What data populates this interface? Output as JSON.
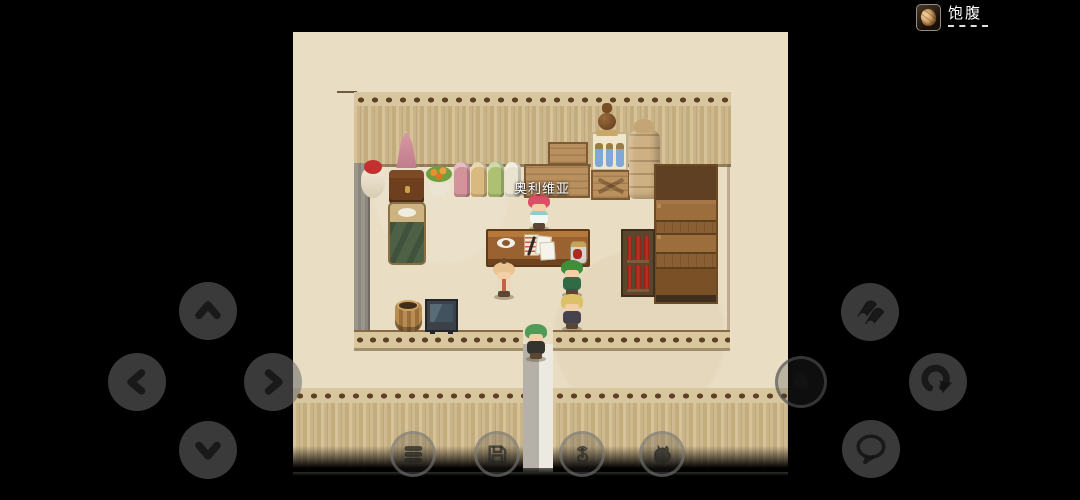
{
  "screen": {
    "width": 1080,
    "height": 500,
    "background": "#000000"
  },
  "hud": {
    "satiety": {
      "label": "饱腹",
      "icon": "bread-icon",
      "underline_style": "dashed"
    }
  },
  "game": {
    "scene": "shop-interior",
    "npc_label": "奥利维亚",
    "characters": [
      "olivia-shopkeeper",
      "child-npc",
      "green-hair-npc",
      "blonde-player",
      "hooded-visitor"
    ],
    "objects": [
      "mannequin",
      "red-doll",
      "wooden-chest",
      "flower-pot",
      "fabric-bolts",
      "crate-stack",
      "jug-on-crate",
      "blue-bottle-crate",
      "brace-crate",
      "sack-pile",
      "goods-shelf",
      "red-bottle-shelf",
      "bread-baskets",
      "counter-desk",
      "coffee-cup",
      "papers-and-quill",
      "preserve-jar",
      "bed",
      "wooden-tub",
      "display-case",
      "door-path"
    ],
    "palette": {
      "floor": "#e9ddc4",
      "wall_plank": "#cdb88f",
      "wall_knob": "#5d4026",
      "letterbox": "#000000"
    }
  },
  "controls": {
    "dpad": [
      {
        "name": "up",
        "icon": "chevron-up-icon"
      },
      {
        "name": "left",
        "icon": "chevron-left-icon"
      },
      {
        "name": "right",
        "icon": "chevron-right-icon"
      },
      {
        "name": "down",
        "icon": "chevron-down-icon"
      }
    ],
    "right_buttons": [
      {
        "name": "dash",
        "icon": "dash-streaks-icon"
      },
      {
        "name": "item-bag",
        "icon": "money-bag-icon"
      },
      {
        "name": "redo",
        "icon": "redo-arrow-icon"
      },
      {
        "name": "chat",
        "icon": "speech-bubble-icon"
      }
    ],
    "bottom_buttons": [
      {
        "name": "menu",
        "icon": "hamburger-icon"
      },
      {
        "name": "save",
        "icon": "floppy-disk-icon"
      },
      {
        "name": "touch",
        "icon": "pointing-hand-icon"
      },
      {
        "name": "monster",
        "icon": "monster-icon"
      }
    ]
  }
}
